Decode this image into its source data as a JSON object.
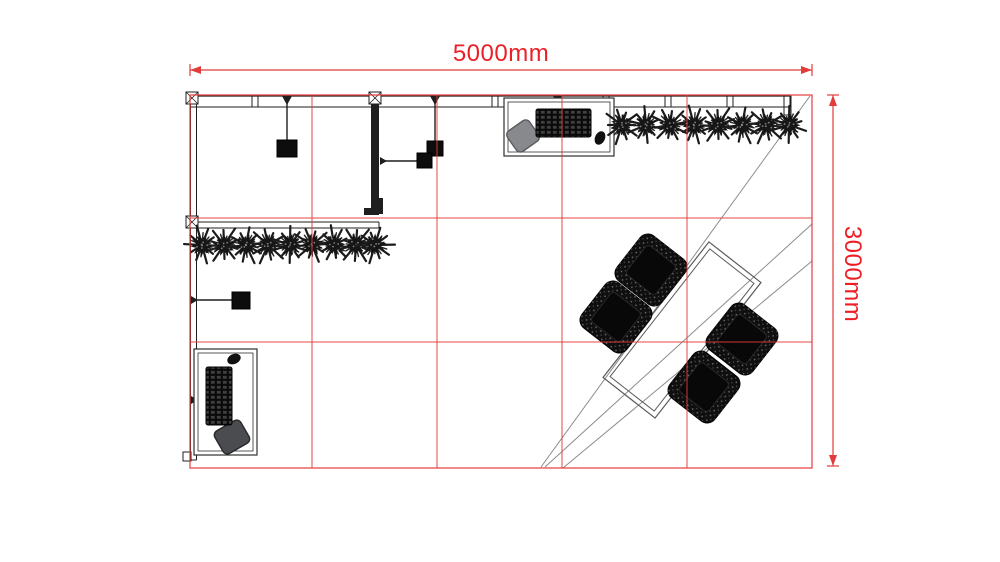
{
  "meta": {
    "drawing_type": "exhibition-booth-floor-plan",
    "canvas": {
      "width": 1000,
      "height": 562
    },
    "background": "#ffffff"
  },
  "colors": {
    "red_line": "#e23b3b",
    "red_text": "#ec1f26",
    "wall": "#1f1f1f",
    "gray_line": "#8c8c8c",
    "desk_stroke": "#2f2f2f",
    "light_fill": "#0d0d0d",
    "table_stroke": "#5a5a5a",
    "plant_fill": "#161616",
    "wicker_fill": "#0f0f0f",
    "chair_gray_fill": "#87898c",
    "chair_gray_stroke": "#595b5e",
    "chair_dark_fill": "#4a4c4f",
    "chair_dark_stroke": "#26282a"
  },
  "dimensions": {
    "width_label": "5000mm",
    "height_label": "3000mm",
    "width_value_mm": 5000,
    "height_value_mm": 3000
  },
  "dim_lines": {
    "top": {
      "x1": 190,
      "x2": 812,
      "y": 70
    },
    "right": {
      "x": 833,
      "y1": 95,
      "y2": 466
    }
  },
  "booth": {
    "x": 190,
    "y": 95,
    "width": 622,
    "height": 373,
    "grid_x": [
      312,
      437,
      562,
      687
    ],
    "grid_y": [
      218,
      342
    ]
  },
  "walls": {
    "top": {
      "x1": 190,
      "x2": 790,
      "y_outer": 96,
      "y_inner": 107,
      "ticks": [
        252,
        492,
        603,
        665,
        727
      ]
    },
    "left": {
      "x_outer": 190.5,
      "x_inner": 196.5,
      "y1": 95,
      "y2": 460
    },
    "interior": {
      "x1": 190,
      "x2": 379,
      "y_outer": 222,
      "y_inner": 228
    },
    "corner_stub": {
      "x_outer": 784,
      "x_inner": 791,
      "y1": 95,
      "y2": 115
    },
    "graphic_wall": {
      "x": 371,
      "y": 96,
      "width": 8,
      "height": 119
    },
    "posts": [
      {
        "x": 186,
        "y": 92
      },
      {
        "x": 369,
        "y": 92
      },
      {
        "x": 186,
        "y": 216
      }
    ],
    "post_size": 12,
    "foot_marks": [
      [
        379,
        198,
        4,
        16
      ],
      [
        364,
        208,
        7,
        7
      ]
    ],
    "base_bracket": [
      183,
      452,
      8,
      9
    ]
  },
  "furniture": {
    "lights": [
      {
        "square": [
          277,
          140,
          20,
          17
        ],
        "stem": {
          "x": 287,
          "y1": 96
        }
      },
      {
        "square": [
          427,
          141,
          16,
          15
        ],
        "stem": {
          "x": 435,
          "y1": 96
        }
      },
      {
        "square": [
          417,
          153,
          15,
          15
        ],
        "arm": {
          "y": 161,
          "x1": 380
        }
      },
      {
        "square": [
          550,
          140,
          16,
          14
        ],
        "stem": {
          "x": 558,
          "y1": 96
        },
        "bracket": [
          552,
          100,
          26,
          9
        ]
      },
      {
        "square": [
          232,
          292,
          18,
          17
        ],
        "arm": {
          "y": 300,
          "x1": 191
        }
      },
      {
        "square": [
          235,
          392,
          16,
          16
        ],
        "arm": {
          "y": 400,
          "x1": 191
        }
      }
    ],
    "desks": [
      {
        "rect": [
          504,
          98,
          110,
          58
        ],
        "keyboard": [
          536,
          109,
          55,
          28
        ],
        "mouse": {
          "cx": 600,
          "cy": 138,
          "rx": 5,
          "ry": 7,
          "rot": 25
        },
        "chair": {
          "cx": 523,
          "cy": 136,
          "w": 27,
          "h": 25,
          "rot": -35,
          "style": "gray"
        }
      },
      {
        "rect": [
          194,
          349,
          63,
          106
        ],
        "keyboard": [
          206,
          367,
          26,
          58
        ],
        "mouse": {
          "cx": 234,
          "cy": 359,
          "rx": 7,
          "ry": 5,
          "rot": -25
        },
        "chair": {
          "cx": 232,
          "cy": 437,
          "w": 30,
          "h": 26,
          "rot": -30,
          "style": "dark"
        }
      }
    ],
    "plant_rows": [
      {
        "y": 125,
        "xs": [
          622,
          646,
          670,
          694,
          718,
          742,
          766,
          789
        ]
      },
      {
        "y": 245,
        "xs": [
          202,
          224,
          246,
          268,
          290,
          312,
          334,
          356,
          375
        ]
      }
    ],
    "meeting": {
      "table": {
        "cx": 682,
        "cy": 330,
        "w": 172,
        "h": 66,
        "rot": -52
      },
      "chair_size": 57,
      "chair_rot": -52,
      "chairs": [
        {
          "cx": 651,
          "cy": 270
        },
        {
          "cx": 616,
          "cy": 317
        },
        {
          "cx": 742,
          "cy": 339
        },
        {
          "cx": 704,
          "cy": 387
        }
      ]
    },
    "diagonals": [
      [
        541,
        467,
        810,
        96
      ],
      [
        545,
        467,
        812,
        224
      ],
      [
        563,
        468,
        812,
        261
      ]
    ]
  }
}
